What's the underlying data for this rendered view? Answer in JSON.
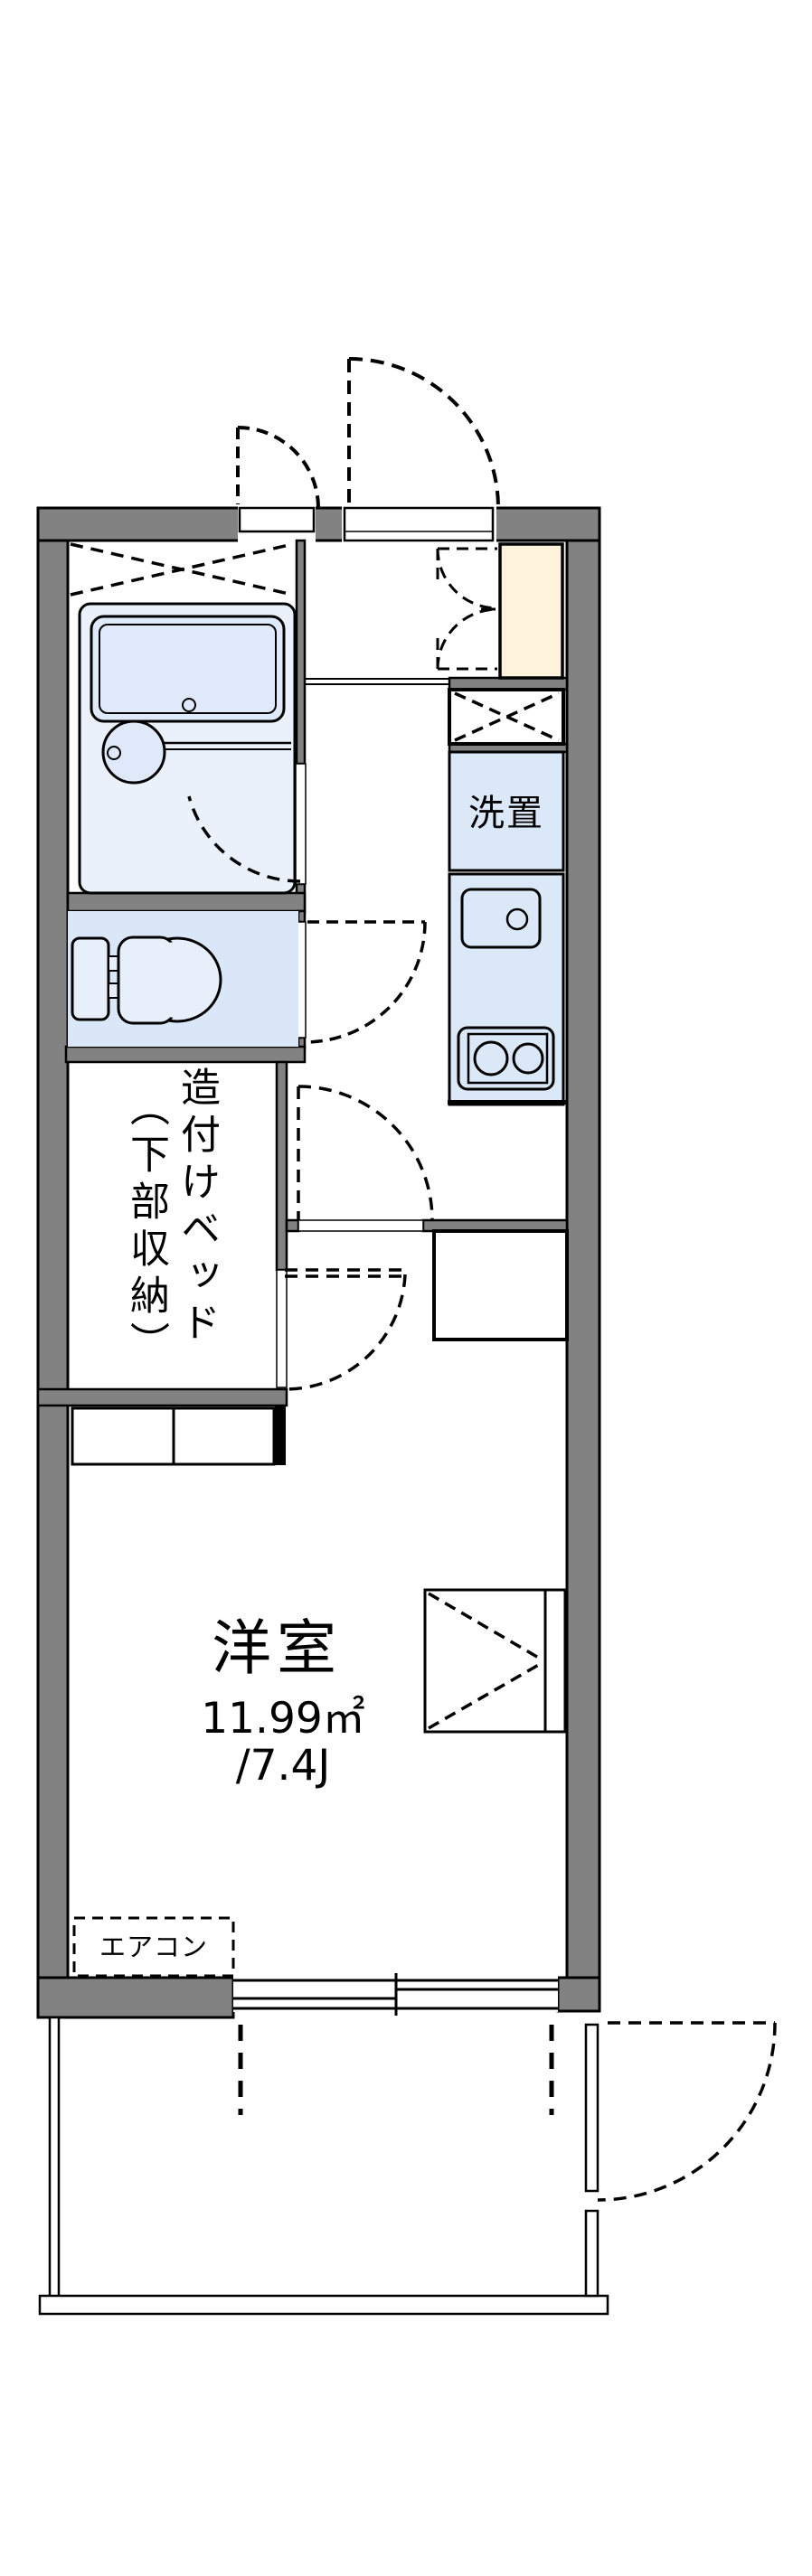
{
  "floorplan": {
    "labels": {
      "washer": "洗置",
      "bed_line1": "造付けベッド",
      "bed_line2": "（下部収納）",
      "room": "洋室",
      "area_m2": "11.99㎡",
      "area_tatami": "/7.4J",
      "aircon": "エアコン"
    },
    "colors": {
      "wall_gray": "#828282",
      "fixture_blue": "#dbe8f8",
      "bath_blue": "#eaf1fb",
      "shoe_cabinet_cream": "#fdf2dc",
      "line_black": "#000000"
    }
  }
}
